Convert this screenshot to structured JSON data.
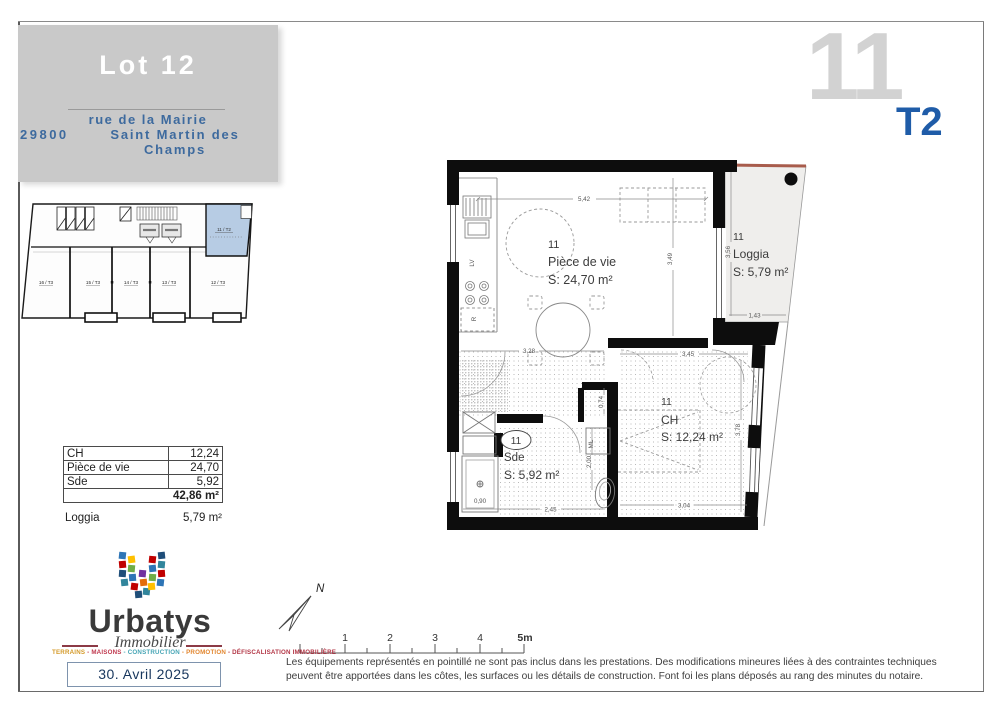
{
  "header": {
    "lot": "Lot 12",
    "postal": "29800",
    "street": "rue de la Mairie",
    "city": "Saint Martin des Champs"
  },
  "unit_badge": {
    "number": "11",
    "type": "T2"
  },
  "key_plan": {
    "highlight": "11 / T2",
    "units": [
      "16 / T3",
      "15 / T3",
      "14 / T3",
      "13 / T3",
      "12 / T3"
    ]
  },
  "areas": {
    "rows": [
      {
        "label": "CH",
        "value": "12,24"
      },
      {
        "label": "Pièce de vie",
        "value": "24,70"
      },
      {
        "label": "Sde",
        "value": "5,92"
      }
    ],
    "total": "42,86 m²",
    "loggia_label": "Loggia",
    "loggia_value": "5,79 m²"
  },
  "plan": {
    "living": {
      "num": "11",
      "name": "Pièce de vie",
      "area": "S: 24,70 m²"
    },
    "loggia": {
      "num": "11",
      "name": "Loggia",
      "area": "S: 5,79 m²"
    },
    "sde": {
      "num": "11",
      "name": "Sde",
      "area": "S: 5,92 m²"
    },
    "ch": {
      "num": "11",
      "name": "CH",
      "area": "S: 12,24 m²"
    },
    "dims": {
      "living_w": "5,42",
      "living_h": "3,49",
      "entry_w": "3,28",
      "ch_top": "3,45",
      "ch_right": "3,78",
      "ch_bottom": "3,04",
      "loggia_h": "3,56",
      "loggia_w": "1,43",
      "nook": "0,74",
      "corridor": "2,00",
      "sde_w": "2,45",
      "shower": "0,90"
    },
    "labels": {
      "lv": "LV",
      "r": "R",
      "ml": "ML"
    }
  },
  "north_label": "N",
  "scale": {
    "ticks": [
      "1",
      "2",
      "3",
      "4",
      "5m"
    ]
  },
  "logo": {
    "brand": "Urbatys",
    "division": "Immobilier",
    "tagline": [
      {
        "text": "TERRAINS",
        "color": "#d49a2a"
      },
      {
        "text": " - MAISONS",
        "color": "#c0394f"
      },
      {
        "text": " - CONSTRUCTION",
        "color": "#46a5b5"
      },
      {
        "text": " - PROMOTION",
        "color": "#e2862f"
      },
      {
        "text": " - DÉFISCALISATION IMMOBILIÈRE",
        "color": "#b23545"
      }
    ],
    "date": "30. Avril 2025"
  },
  "disclaimer": {
    "line1": "Les équipements représentés en pointillé ne sont pas inclus dans les prestations. Des modifications mineures liées à des contraintes techniques",
    "line2": "peuvent être apportées dans les côtes, les surfaces ou les détails de construction. Font foi les plans déposés au rang des minutes du notaire."
  },
  "colors": {
    "header_box": "#c9c9c9",
    "header_text_blue": "#3d6a9e",
    "unit_number_gray": "#d2d2d2",
    "unit_type_blue": "#1f5ca8",
    "key_plan_highlight": "#b7cce4",
    "date_navy": "#17365d",
    "loggia_fill": "#efeeec",
    "loggia_edge_red": "#a85c4c"
  }
}
